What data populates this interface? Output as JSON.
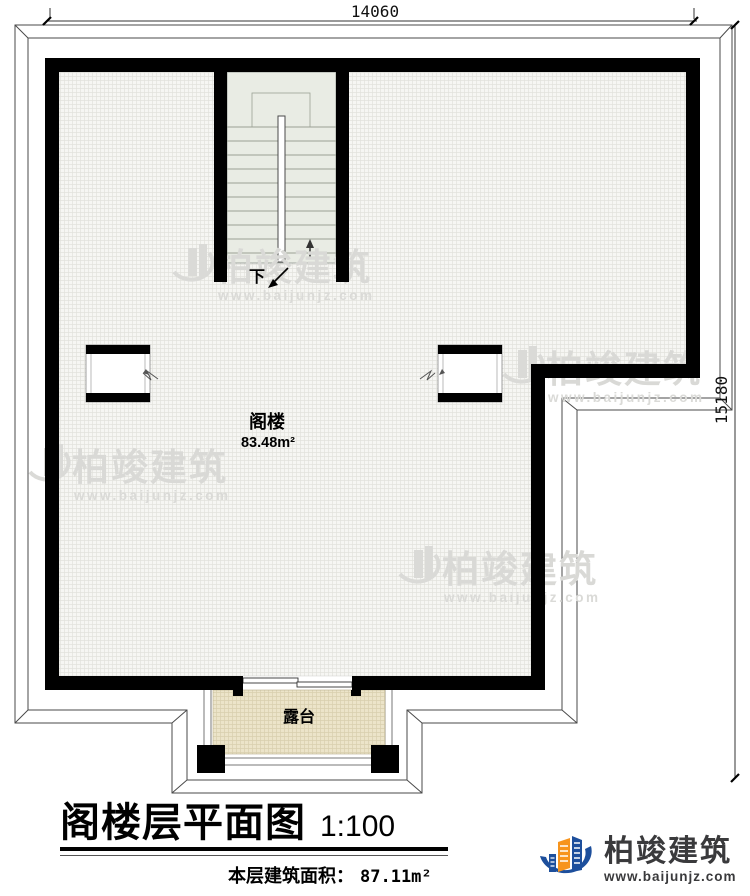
{
  "dimensions": {
    "top": "14060",
    "right": "15180"
  },
  "plan": {
    "room_label": "阁楼",
    "room_area": "83.48m²",
    "stairs_down_label": "下",
    "terrace_label": "露台"
  },
  "watermark": {
    "brand": "柏竣建筑",
    "url": "www.baijunjz.com"
  },
  "title_block": {
    "title": "阁楼层平面图",
    "scale": "1:100",
    "area_label": "本层建筑面积：",
    "area_value": "87.11m²"
  },
  "logo": {
    "brand": "柏竣建筑",
    "url": "www.baijunjz.com"
  },
  "colors": {
    "wall": "#000000",
    "floor": "#f6f6f3",
    "stair": "#e9ece4",
    "terrace": "#ece4c9",
    "watermark": "#d9d9d6",
    "logo_blue": "#1d4f9c",
    "logo_orange": "#f7941d"
  }
}
